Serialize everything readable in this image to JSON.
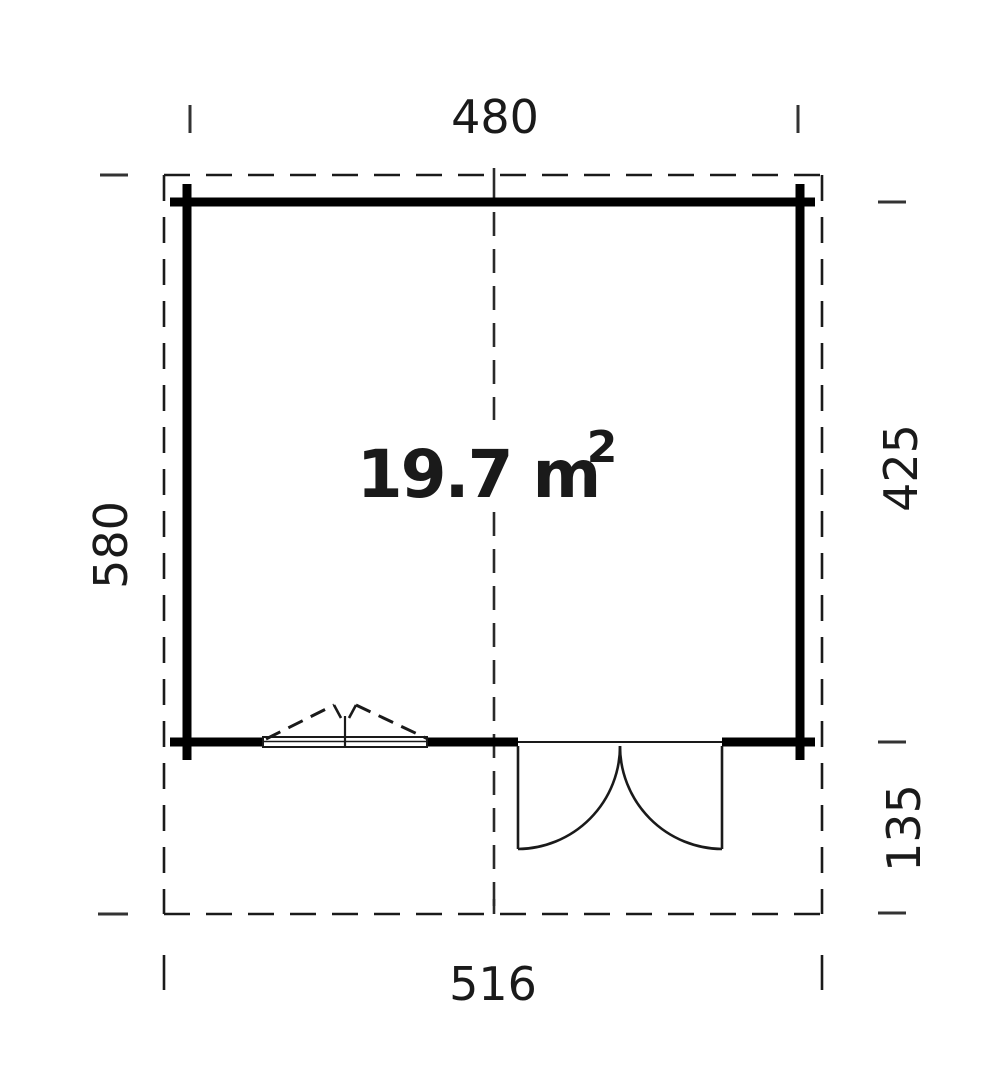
{
  "plan": {
    "type": "cabin-floor-plan",
    "background_color": "#ffffff",
    "wall_color": "#000000",
    "line_color": "#1a1a1a",
    "area": {
      "value": "19.7 m",
      "exponent": "2",
      "full": "19.7 m²"
    },
    "dimensions": {
      "top_wall_width": "480",
      "bottom_roof_width": "516",
      "left_total_depth": "580",
      "right_building_depth": "425",
      "right_overhang_depth": "135"
    },
    "features": {
      "window": "tilt-window-front-left",
      "door": "double-door-outward-front-right"
    }
  }
}
